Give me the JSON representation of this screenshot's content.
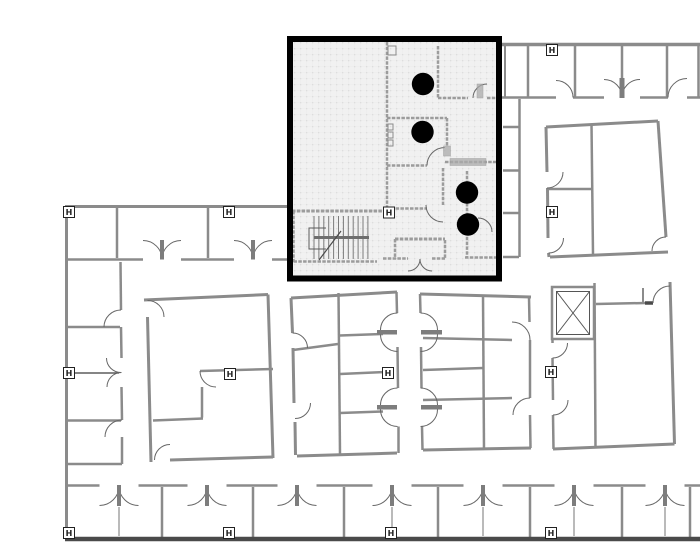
{
  "plan": {
    "canvas": {
      "width": 700,
      "height": 547,
      "background": "#ffffff"
    },
    "colors": {
      "highlight_border": "#000000",
      "highlight_fill": "#f1f1f1",
      "wall_gray": "#8b8b8b",
      "wall_dark": "#4a4a4a",
      "dot": "#000000"
    },
    "highlight_region": {
      "x": 290,
      "y": 39,
      "w": 209,
      "h": 239.5,
      "border_w": 6
    },
    "marker_label": "H",
    "markers": [
      [
        552,
        50
      ],
      [
        69,
        212
      ],
      [
        229,
        212
      ],
      [
        389,
        212.5
      ],
      [
        552,
        212
      ],
      [
        69,
        373
      ],
      [
        230,
        374
      ],
      [
        388,
        373
      ],
      [
        551,
        372
      ],
      [
        69,
        533
      ],
      [
        229,
        533
      ],
      [
        391,
        533
      ],
      [
        551,
        533
      ]
    ],
    "dots": {
      "r": 11.2,
      "points": [
        [
          423,
          84
        ],
        [
          422.5,
          132
        ],
        [
          467,
          192.5
        ],
        [
          468,
          224.5
        ]
      ]
    },
    "elevator": {
      "outer": [
        552,
        287,
        42,
        52
      ],
      "inner": [
        556.5,
        291.5,
        33,
        43
      ]
    },
    "stairs": {
      "x0": 314,
      "step": 4.9,
      "count": 12,
      "y1": 216,
      "y2": 259,
      "rail": [
        314,
        237.5,
        369,
        237.5
      ],
      "u_rail": "326,228 309,228 309,249 326,249",
      "diag": [
        319,
        260,
        341,
        231
      ]
    },
    "walls": [
      [
        500,
        44.5,
        700,
        44.5,
        3.5,
        ""
      ],
      [
        502,
        97.5,
        556,
        97.5,
        2.5,
        ""
      ],
      [
        573,
        97.5,
        604,
        97.5,
        2.5,
        ""
      ],
      [
        640,
        97.5,
        668,
        97.5,
        2.5,
        ""
      ],
      [
        687,
        97.5,
        700,
        97.5,
        2.5,
        ""
      ],
      [
        505,
        46,
        505,
        97,
        2,
        ""
      ],
      [
        528,
        46,
        528,
        97,
        2.5,
        ""
      ],
      [
        575,
        46,
        575,
        97,
        2.5,
        ""
      ],
      [
        622,
        46,
        622,
        80,
        2.5,
        ""
      ],
      [
        667,
        46,
        667,
        97,
        2.5,
        ""
      ],
      [
        698.5,
        46,
        698.5,
        97,
        2.5,
        ""
      ],
      [
        519.5,
        99,
        519.5,
        257,
        2.5,
        ""
      ],
      [
        503,
        127,
        519,
        127,
        2.5,
        ""
      ],
      [
        503,
        170.5,
        519,
        170.5,
        2.5,
        ""
      ],
      [
        503,
        213,
        519,
        213,
        2.5,
        ""
      ],
      [
        503,
        257,
        519,
        257,
        2.5,
        ""
      ],
      [
        546,
        127,
        658,
        121,
        3,
        ""
      ],
      [
        658,
        121,
        666,
        237,
        3,
        ""
      ],
      [
        668,
        252,
        550,
        257,
        3,
        ""
      ],
      [
        546,
        127,
        547,
        172,
        3,
        ""
      ],
      [
        547.5,
        188,
        548,
        238,
        3,
        ""
      ],
      [
        548.5,
        253,
        549,
        257,
        3,
        ""
      ],
      [
        591.5,
        124,
        593,
        254,
        2.5,
        ""
      ],
      [
        548,
        189,
        591,
        189,
        2.5,
        ""
      ],
      [
        144,
        300,
        268,
        294.5,
        3,
        ""
      ],
      [
        268,
        294.5,
        273,
        458,
        3,
        ""
      ],
      [
        170,
        460,
        273,
        457,
        3,
        ""
      ],
      [
        147.5,
        317,
        151,
        462,
        3,
        ""
      ],
      [
        200,
        371,
        273,
        369,
        2.5,
        ""
      ],
      [
        202,
        387,
        202,
        417.5,
        2.5,
        ""
      ],
      [
        153,
        420.5,
        203,
        418.5,
        2.5,
        ""
      ],
      [
        291,
        298,
        397,
        292,
        3,
        ""
      ],
      [
        291,
        298,
        292.5,
        333,
        3,
        ""
      ],
      [
        293,
        348,
        294,
        403,
        3,
        ""
      ],
      [
        295,
        422,
        295.5,
        455,
        3,
        ""
      ],
      [
        297,
        456,
        397,
        453,
        3,
        ""
      ],
      [
        338.5,
        293,
        340,
        454,
        2.5,
        ""
      ],
      [
        293,
        350,
        338,
        344,
        2.5,
        ""
      ],
      [
        340,
        335.5,
        383,
        334,
        2.5,
        ""
      ],
      [
        340,
        374,
        386,
        372,
        2.5,
        ""
      ],
      [
        340,
        413,
        383,
        411.5,
        2.5,
        ""
      ],
      [
        396.5,
        292,
        397,
        313,
        2.5,
        ""
      ],
      [
        397.5,
        347,
        398,
        388,
        2.5,
        ""
      ],
      [
        398.5,
        426.5,
        398.5,
        453,
        2.5,
        ""
      ],
      [
        420,
        294,
        420.5,
        313,
        2.5,
        ""
      ],
      [
        421,
        347,
        421.5,
        388,
        2.5,
        ""
      ],
      [
        422,
        426.5,
        422.5,
        450,
        2.5,
        ""
      ],
      [
        420,
        294,
        531,
        297,
        3,
        ""
      ],
      [
        423,
        450,
        531,
        448,
        3,
        ""
      ],
      [
        483,
        295,
        484,
        449,
        2.5,
        ""
      ],
      [
        423,
        338,
        512,
        340,
        2.5,
        ""
      ],
      [
        423,
        370,
        483,
        368,
        2.5,
        ""
      ],
      [
        423,
        400,
        512,
        398,
        2.5,
        ""
      ],
      [
        529,
        297,
        529.5,
        322,
        2.5,
        ""
      ],
      [
        530,
        340,
        530,
        398,
        2.5,
        ""
      ],
      [
        530,
        415,
        530.5,
        448,
        2.5,
        ""
      ],
      [
        552.5,
        339,
        552.5,
        343,
        2.5,
        ""
      ],
      [
        552.5,
        358,
        553,
        400,
        2.5,
        ""
      ],
      [
        553,
        415,
        553.5,
        449,
        2.5,
        ""
      ],
      [
        594.5,
        283,
        595.5,
        448,
        2.5,
        ""
      ],
      [
        596,
        304,
        645,
        303,
        2.5,
        ""
      ],
      [
        645,
        303,
        653,
        303,
        3.5,
        "d"
      ],
      [
        643,
        288,
        643,
        303,
        2,
        ""
      ],
      [
        670,
        282,
        674.5,
        444,
        3,
        ""
      ],
      [
        553,
        449,
        674.5,
        444,
        3,
        ""
      ],
      [
        65,
        206.5,
        289,
        206.5,
        3,
        ""
      ],
      [
        65,
        259.5,
        143,
        259.5,
        2.5,
        ""
      ],
      [
        181,
        259.5,
        234,
        259.5,
        2.5,
        ""
      ],
      [
        272,
        259.5,
        289,
        259.5,
        2.5,
        ""
      ],
      [
        117,
        208,
        117,
        258,
        2.5,
        ""
      ],
      [
        208,
        208,
        208,
        258,
        2.5,
        ""
      ],
      [
        66.5,
        206.5,
        66.5,
        539,
        3,
        ""
      ],
      [
        120.5,
        262,
        121,
        310,
        2.5,
        ""
      ],
      [
        121,
        327,
        121.5,
        358,
        2.5,
        ""
      ],
      [
        121.5,
        387,
        122,
        420,
        2.5,
        ""
      ],
      [
        122,
        437,
        122,
        464,
        2.5,
        ""
      ],
      [
        68,
        327,
        120,
        327,
        2.5,
        ""
      ],
      [
        68,
        420.5,
        121,
        420.5,
        2.5,
        ""
      ],
      [
        67,
        464,
        122,
        464,
        2.5,
        ""
      ],
      [
        70,
        373,
        119,
        373,
        1.2,
        "k"
      ],
      [
        65,
        485.5,
        99.5,
        485.5,
        2.5,
        ""
      ],
      [
        138.5,
        485.5,
        187.5,
        485.5,
        2.5,
        ""
      ],
      [
        226.5,
        485.5,
        277.5,
        485.5,
        2.5,
        ""
      ],
      [
        316.5,
        485.5,
        372.5,
        485.5,
        2.5,
        ""
      ],
      [
        411.5,
        485.5,
        463.5,
        485.5,
        2.5,
        ""
      ],
      [
        502.5,
        485.5,
        554.5,
        485.5,
        2.5,
        ""
      ],
      [
        593.5,
        485.5,
        645.5,
        485.5,
        2.5,
        ""
      ],
      [
        684.5,
        485.5,
        700,
        485.5,
        2.5,
        ""
      ],
      [
        162,
        487,
        162,
        537,
        2.5,
        ""
      ],
      [
        253,
        487,
        253,
        537,
        2.5,
        ""
      ],
      [
        344,
        487,
        344,
        537,
        2.5,
        ""
      ],
      [
        438,
        487,
        438,
        537,
        2.5,
        ""
      ],
      [
        530,
        487,
        530,
        537,
        2.5,
        ""
      ],
      [
        622,
        487,
        622,
        537,
        2.5,
        ""
      ],
      [
        690,
        487,
        690,
        537,
        2.5,
        ""
      ],
      [
        119,
        507,
        119,
        536,
        1.2,
        ""
      ],
      [
        392,
        507,
        392,
        536,
        1.2,
        ""
      ],
      [
        483,
        507,
        483,
        536,
        1.2,
        ""
      ],
      [
        574,
        507,
        574,
        536,
        1.2,
        ""
      ],
      [
        665,
        507,
        665,
        536,
        1.2,
        ""
      ],
      [
        65,
        539,
        700,
        539,
        4.5,
        "d"
      ],
      [
        387,
        42,
        387,
        211,
        2.5,
        "h"
      ],
      [
        438,
        46,
        438,
        98,
        2.5,
        "h"
      ],
      [
        438,
        98,
        468,
        98,
        2.5,
        "h"
      ],
      [
        487,
        98,
        500,
        98,
        2.5,
        "h"
      ],
      [
        387,
        118,
        447,
        118,
        2.5,
        "h"
      ],
      [
        447,
        118,
        447,
        146,
        2.5,
        "h"
      ],
      [
        445,
        162,
        499,
        162,
        2.5,
        "h"
      ],
      [
        387,
        165.5,
        427,
        165.5,
        2.5,
        "h"
      ],
      [
        443,
        168,
        443,
        205,
        2.5,
        "h"
      ],
      [
        386,
        208.5,
        427,
        208.5,
        2.5,
        "h"
      ],
      [
        292,
        211,
        386,
        211,
        3,
        "h"
      ],
      [
        293.5,
        211,
        293.5,
        262,
        2.5,
        "h"
      ],
      [
        293.5,
        261.5,
        377,
        261.5,
        2.5,
        "h"
      ],
      [
        467,
        171,
        467,
        183,
        2.5,
        "h"
      ],
      [
        467,
        203,
        467,
        213.5,
        2.5,
        "h"
      ],
      [
        467,
        232,
        467,
        257,
        2.5,
        "h"
      ],
      [
        465,
        257.5,
        499,
        257.5,
        2.5,
        "h"
      ],
      [
        395,
        239,
        445,
        239,
        3,
        "h"
      ],
      [
        395,
        239,
        395,
        258.5,
        2.5,
        "h"
      ],
      [
        445,
        240,
        445,
        258.5,
        2.5,
        "h"
      ],
      [
        383,
        258.5,
        408,
        258.5,
        2.5,
        "h"
      ],
      [
        432,
        258.5,
        445,
        258.5,
        2.5,
        "h"
      ]
    ],
    "arcs": [
      [
        556,
        97.5,
        17,
        -90,
        0
      ],
      [
        604,
        97.5,
        18,
        -90,
        0
      ],
      [
        640,
        97.5,
        18,
        180,
        270
      ],
      [
        687,
        97.5,
        19,
        180,
        270
      ],
      [
        666,
        251,
        14,
        180,
        270
      ],
      [
        547,
        172,
        16,
        0,
        90
      ],
      [
        548.5,
        238,
        15,
        0,
        90
      ],
      [
        147.5,
        317,
        16.5,
        -90,
        0
      ],
      [
        170,
        460,
        15.5,
        180,
        270
      ],
      [
        216,
        371,
        16,
        90,
        180
      ],
      [
        292.5,
        348,
        15,
        -90,
        0
      ],
      [
        295,
        403,
        15.5,
        0,
        90
      ],
      [
        397.5,
        330,
        17,
        180,
        270
      ],
      [
        397.5,
        334.5,
        17,
        90,
        180
      ],
      [
        420.5,
        330,
        17,
        -90,
        0
      ],
      [
        420.5,
        334.5,
        17,
        0,
        90
      ],
      [
        397.5,
        405,
        17,
        180,
        270
      ],
      [
        397.5,
        409.5,
        17,
        90,
        180
      ],
      [
        420.5,
        405,
        17,
        -90,
        0
      ],
      [
        420.5,
        409.5,
        17,
        0,
        90
      ],
      [
        512,
        340,
        18,
        -90,
        0
      ],
      [
        530,
        415,
        17,
        180,
        270
      ],
      [
        552.5,
        343,
        15,
        0,
        90
      ],
      [
        553,
        400,
        15,
        0,
        90
      ],
      [
        670,
        303,
        17,
        180,
        270
      ],
      [
        143,
        259.5,
        19,
        -90,
        0
      ],
      [
        181,
        259.5,
        19,
        180,
        270
      ],
      [
        234,
        259.5,
        19,
        -90,
        0
      ],
      [
        272,
        259.5,
        19,
        180,
        270
      ],
      [
        121,
        327,
        17,
        180,
        270
      ],
      [
        121,
        358,
        14.5,
        90,
        180
      ],
      [
        121.5,
        387,
        14.5,
        180,
        270
      ],
      [
        122,
        437,
        17,
        180,
        270
      ],
      [
        99.5,
        486,
        19.5,
        0,
        90
      ],
      [
        138.5,
        486,
        19.5,
        90,
        180
      ],
      [
        187.5,
        486,
        19.5,
        0,
        90
      ],
      [
        226.5,
        486,
        19.5,
        90,
        180
      ],
      [
        277.5,
        486,
        19.5,
        0,
        90
      ],
      [
        316.5,
        486,
        19.5,
        90,
        180
      ],
      [
        372.5,
        486,
        19.5,
        0,
        90
      ],
      [
        411.5,
        486,
        19.5,
        90,
        180
      ],
      [
        463.5,
        486,
        19.5,
        0,
        90
      ],
      [
        502.5,
        486,
        19.5,
        90,
        180
      ],
      [
        554.5,
        486,
        19.5,
        0,
        90
      ],
      [
        593.5,
        486,
        19.5,
        90,
        180
      ],
      [
        645.5,
        486,
        19.5,
        0,
        90
      ],
      [
        684.5,
        486,
        19.5,
        90,
        180
      ],
      [
        487,
        98,
        14,
        180,
        270
      ],
      [
        445,
        165.5,
        18,
        180,
        270
      ],
      [
        443,
        205,
        17,
        90,
        180
      ],
      [
        478,
        232,
        14,
        -90,
        0
      ],
      [
        408,
        259,
        12,
        0,
        90
      ],
      [
        432,
        259,
        12,
        90,
        180
      ]
    ],
    "posts": [
      [
        619.5,
        78,
        5,
        20
      ],
      [
        160,
        240,
        4,
        19.5
      ],
      [
        251,
        240,
        4,
        19.5
      ],
      [
        117,
        485,
        4,
        21
      ],
      [
        205,
        485,
        4,
        21
      ],
      [
        295,
        485,
        4,
        21
      ],
      [
        390,
        485,
        4,
        21
      ],
      [
        481,
        485,
        4,
        21
      ],
      [
        572,
        485,
        4,
        21
      ],
      [
        663,
        485,
        4,
        21
      ],
      [
        377,
        330,
        20,
        4.5
      ],
      [
        421,
        330,
        21,
        4.5
      ],
      [
        377,
        405,
        20,
        4.5
      ],
      [
        421,
        405,
        21,
        4.5
      ]
    ],
    "hatches": [
      [
        477,
        84,
        6,
        14
      ],
      [
        443.5,
        146,
        7,
        10
      ],
      [
        450,
        158.5,
        36,
        7
      ]
    ],
    "boxes": [
      [
        388,
        46,
        8,
        9
      ],
      [
        388,
        124,
        5,
        6
      ],
      [
        388,
        132,
        5,
        6
      ],
      [
        388,
        140,
        5,
        6
      ]
    ]
  }
}
